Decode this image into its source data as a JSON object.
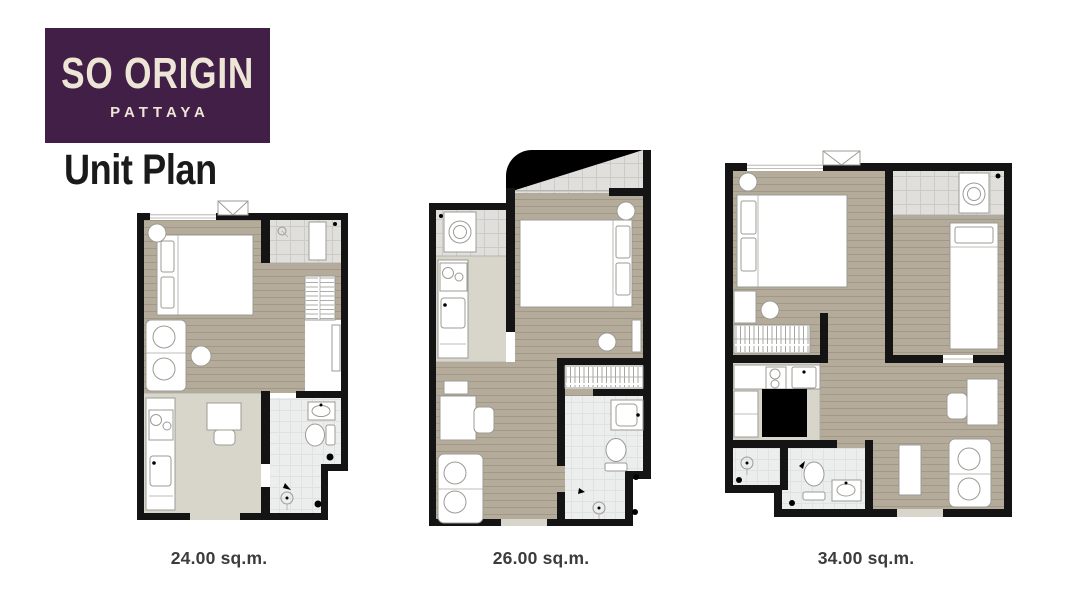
{
  "brand": {
    "name": "SO ORIGIN",
    "location": "PATTAYA"
  },
  "heading": "Unit Plan",
  "plans": [
    {
      "name": "unit-24sqm",
      "area_label": "24.00 sq.m."
    },
    {
      "name": "unit-26sqm",
      "area_label": "26.00 sq.m."
    },
    {
      "name": "unit-34sqm",
      "area_label": "34.00 sq.m."
    }
  ],
  "palette": {
    "brand_bg": "#411f46",
    "brand_text": "#ede5d6",
    "heading_text": "#1a1a1a",
    "label_text": "#3c3c3c",
    "wall": "#141414",
    "wood": "#b5ab9b",
    "tile": "#e0dfdc",
    "kfloor": "#d8d6cb",
    "bfloor": "#eceded",
    "furn": "#9b9b96"
  }
}
